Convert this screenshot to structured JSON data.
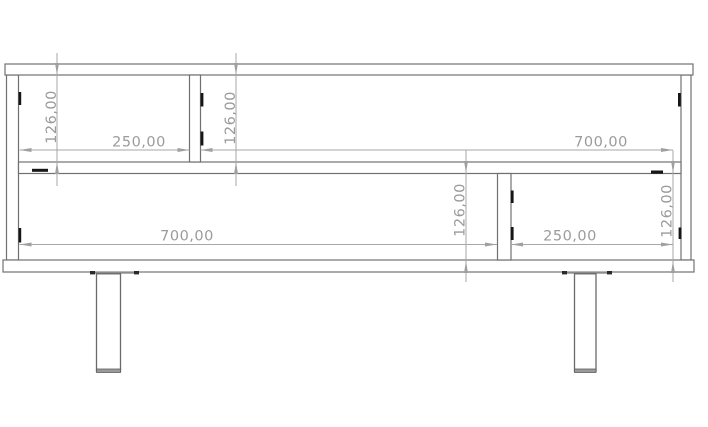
{
  "drawing": {
    "type": "furniture-technical-front-view",
    "background_color": "#ffffff",
    "outline_color": "#717171",
    "dimension_color": "#a7a7a7",
    "dimension_text_color": "#9b9b9b",
    "connector_mark_color": "#161616",
    "dims": {
      "upper_left_height": "126,00",
      "upper_left_width": "250,00",
      "upper_mid_height": "126,00",
      "upper_right_width": "700,00",
      "lower_left_width": "700,00",
      "lower_mid_height": "126,00",
      "lower_right_width": "250,00",
      "lower_right_height": "126,00"
    }
  }
}
